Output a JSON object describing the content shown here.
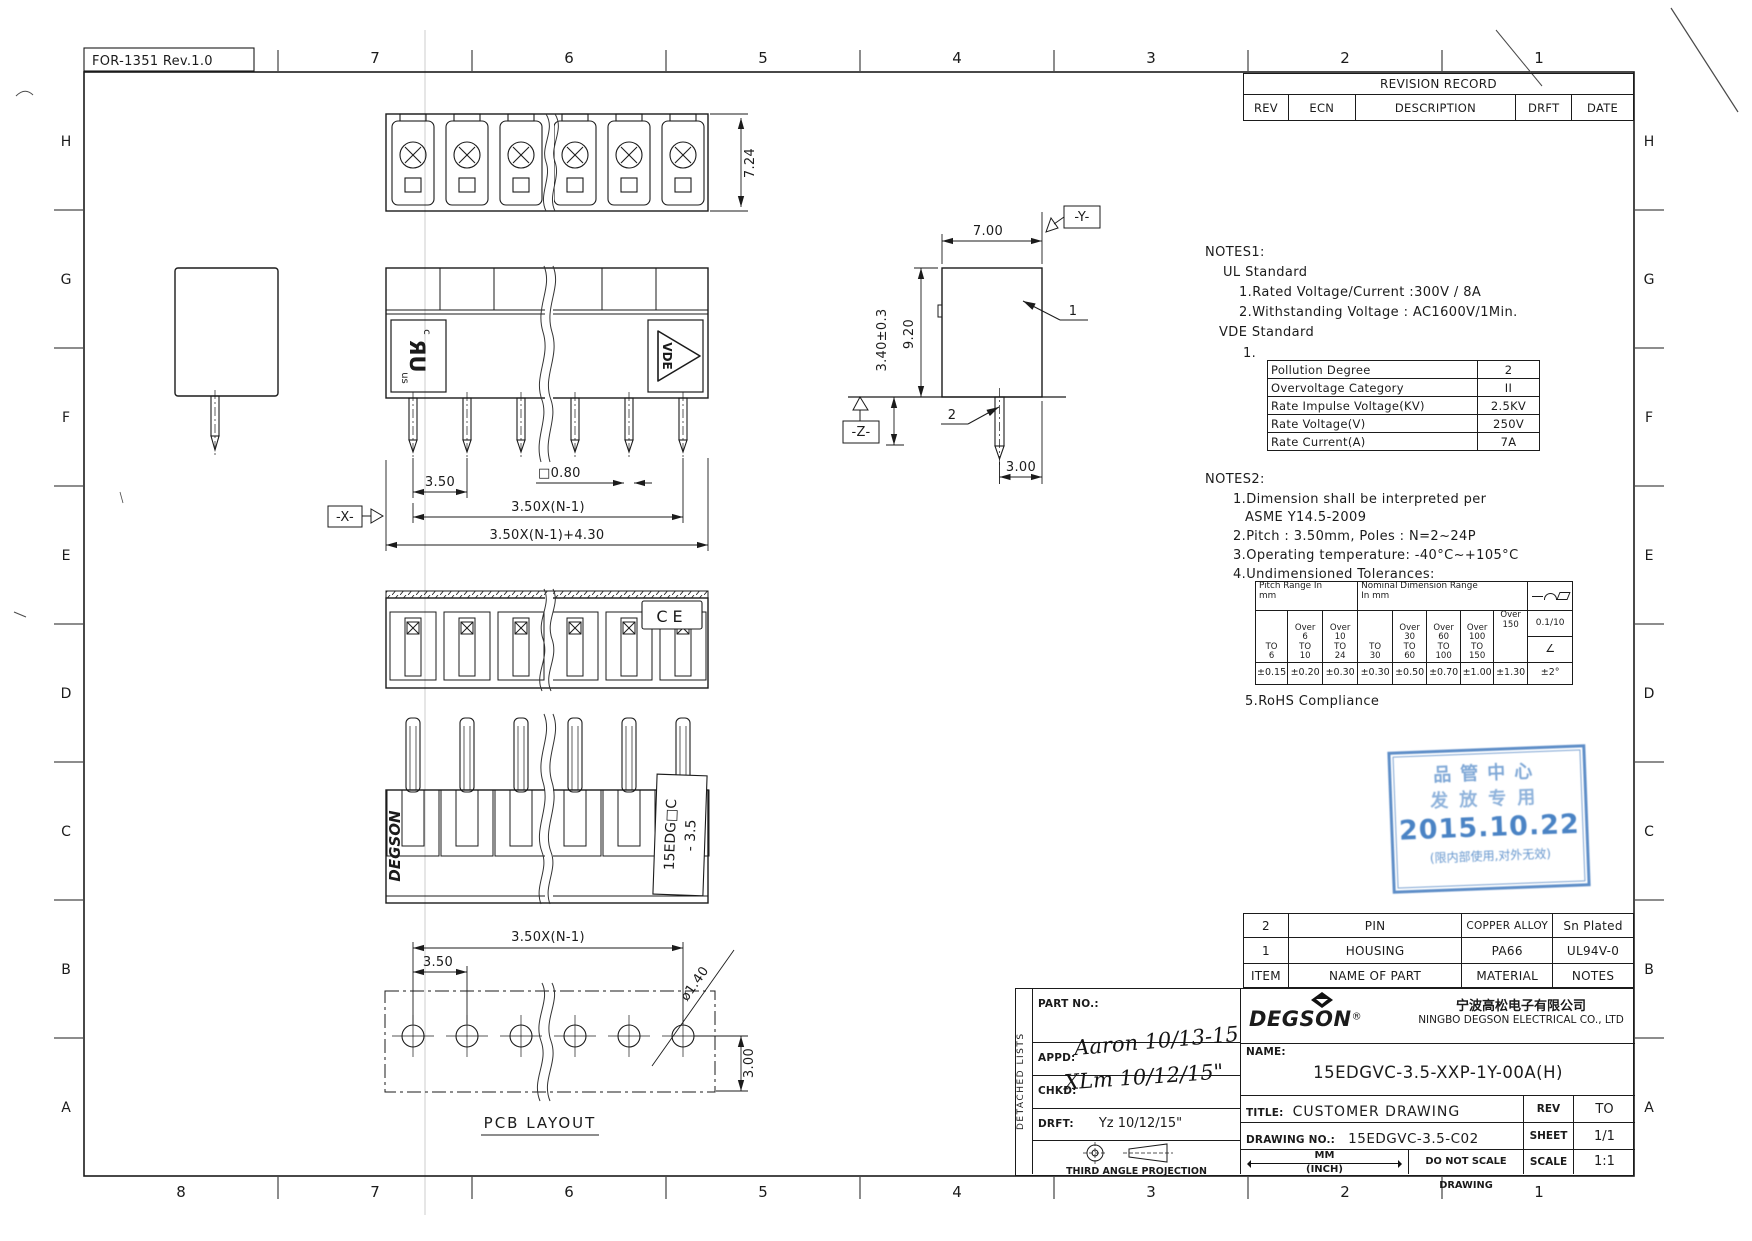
{
  "sheet": {
    "form_label": "FOR-1351 Rev.1.0",
    "top_ruler": [
      "7",
      "6",
      "5",
      "4",
      "3",
      "2",
      "1"
    ],
    "bottom_ruler": [
      "8",
      "7",
      "6",
      "5",
      "4",
      "3",
      "2",
      "1"
    ],
    "left_zones": [
      "H",
      "G",
      "F",
      "E",
      "D",
      "C",
      "B",
      "A"
    ],
    "right_zones": [
      "H",
      "G",
      "F",
      "E",
      "D",
      "C",
      "B",
      "A"
    ]
  },
  "revision_table": {
    "title": "REVISION RECORD",
    "headers": [
      "REV",
      "ECN",
      "DESCRIPTION",
      "DRFT",
      "DATE"
    ]
  },
  "notes1": {
    "heading": "NOTES1:",
    "ul_heading": "UL Standard",
    "ul_item1": "1.Rated Voltage/Current :300V / 8A",
    "ul_item2": "2.Withstanding Voltage : AC1600V/1Min.",
    "vde_heading": "VDE Standard",
    "vde_item_no": "1.",
    "vde_table": {
      "rows": [
        {
          "label": "Pollution Degree",
          "value": "2"
        },
        {
          "label": "Overvoltage Category",
          "value": "II"
        },
        {
          "label": "Rate Impulse Voltage(KV)",
          "value": "2.5KV"
        },
        {
          "label": "Rate Voltage(V)",
          "value": "250V"
        },
        {
          "label": "Rate Current(A)",
          "value": "7A"
        }
      ]
    }
  },
  "notes2": {
    "heading": "NOTES2:",
    "item1": "1.Dimension shall be interpreted per",
    "item1b": "ASME Y14.5-2009",
    "item2": "2.Pitch : 3.50mm, Poles : N=2~24P",
    "item3": "3.Operating temperature: -40°C~+105°C",
    "item4": "4.Undimensioned Tolerances:",
    "item5": "5.RoHS Compliance"
  },
  "tolerance_table": {
    "pitch_header": "Pitch Range In\nmm",
    "nominal_header": "Nominal Dimension Range\nIn mm",
    "header_symbols": [
      "straightness-line-icon",
      "arc-icon",
      "parallelogram-icon"
    ],
    "pitch_cols": [
      "TO\n6",
      "Over\n6\nTO\n10",
      "Over\n10\nTO\n24"
    ],
    "nominal_cols": [
      "TO\n30",
      "Over\n30\nTO\n60",
      "Over\n60\nTO\n100",
      "Over\n100\nTO\n150",
      "Over\n150"
    ],
    "values": [
      "±0.15",
      "±0.20",
      "±0.30",
      "±0.30",
      "±0.50",
      "±0.70",
      "±1.00",
      "±1.30"
    ],
    "flatness_value": "0.1/10",
    "angle_symbol": "∠",
    "angle_value": "±2°"
  },
  "stamp": {
    "line1": "品管中心",
    "line2": "发放专用",
    "date": "2015.10.22",
    "line3": "(限内部使用,对外无效)",
    "color": "#3b79c0"
  },
  "parts_table": {
    "headers": {
      "item": "ITEM",
      "name": "NAME OF PART",
      "material": "MATERIAL",
      "notes": "NOTES"
    },
    "rows": [
      {
        "item": "2",
        "name": "PIN",
        "material": "COPPER ALLOY",
        "notes": "Sn Plated"
      },
      {
        "item": "1",
        "name": "HOUSING",
        "material": "PA66",
        "notes": "UL94V-0"
      }
    ]
  },
  "title_block": {
    "detached_lists": "DETACHED LISTS",
    "part_no_label": "PART NO.:",
    "appd_label": "APPD:",
    "appd_value": "Aaron 10/13-15",
    "chkd_label": "CHKD:",
    "chkd_value": "XLm 10/12/15\"",
    "drft_label": "DRFT:",
    "drft_value": "Yz 10/12/15\"",
    "projection_label": "THIRD ANGLE PROJECTION",
    "brand": "DEGSON",
    "brand_reg": "®",
    "company_cn": "宁波高松电子有限公司",
    "company_en": "NINGBO DEGSON ELECTRICAL CO., LTD",
    "name_label": "NAME:",
    "part_name": "15EDGVC-3.5-XXP-1Y-00A(H)",
    "title_label": "TITLE:",
    "title_value": "CUSTOMER DRAWING",
    "rev_label": "REV",
    "rev_value": "TO",
    "drawing_no_label": "DRAWING NO.:",
    "drawing_no": "15EDGVC-3.5-C02",
    "sheet_label": "SHEET",
    "sheet_value": "1/1",
    "units_mm": "MM",
    "units_inch": "(INCH)",
    "no_scale": "DO NOT SCALE DRAWING",
    "scale_label": "SCALE",
    "scale_value": "1:1"
  },
  "drawing": {
    "top_view": {
      "dim_height": "7.24"
    },
    "front_view": {
      "dim_pitch": "3.50",
      "dim_pin_square": "□0.80",
      "dim_span": "3.50X(N-1)",
      "dim_overall": "3.50X(N-1)+4.30",
      "datum_x": "-X-",
      "ul_c": "c",
      "ul_mark": "ЯU",
      "ul_us": "us",
      "vde_mark": "VDE"
    },
    "ce_view": {
      "ce_mark": "CE"
    },
    "rear_view": {
      "brand": "DEGSON",
      "model_line1": "15EDG□C",
      "model_line2": "- 3.5"
    },
    "side_view": {
      "dim_width": "7.00",
      "dim_body": "9.20",
      "dim_pin": "3.40±0.3",
      "dim_pin_edge": "3.00",
      "datum_y": "-Y-",
      "datum_z": "-Z-",
      "callout_housing": "1",
      "callout_pin": "2"
    },
    "pcb_view": {
      "dim_span": "3.50X(N-1)",
      "dim_pitch": "3.50",
      "dim_hole": "ø1.40",
      "dim_edge": "3.00",
      "caption": "PCB LAYOUT"
    }
  }
}
